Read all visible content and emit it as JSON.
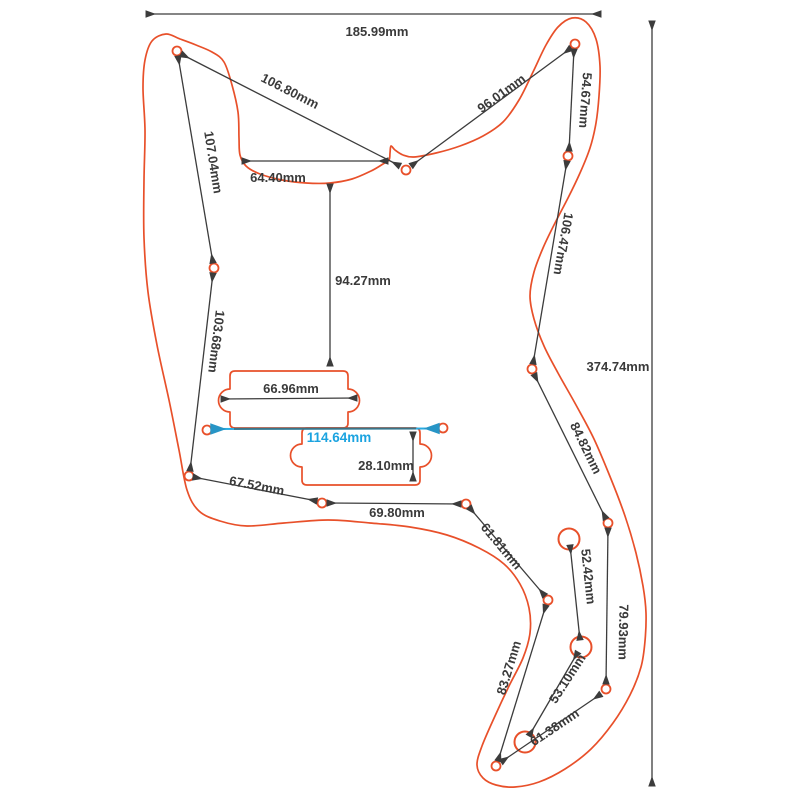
{
  "diagram": {
    "title": "Bass pickguard dimension drawing",
    "units": "mm",
    "colors": {
      "outline": "#e8502a",
      "dimension_line": "#3c3c3c",
      "highlight": "#1ba3e0",
      "background": "#ffffff"
    },
    "labels": {
      "d185_99": "185.99mm",
      "d106_80": "106.80mm",
      "d96_01": "96.01mm",
      "d54_67": "54.67mm",
      "d107_04": "107.04mm",
      "d64_40": "64.40mm",
      "d94_27": "94.27mm",
      "d103_68": "103.68mm",
      "d106_47": "106.47mm",
      "d374_74": "374.74mm",
      "d84_82": "84.82mm",
      "d66_96": "66.96mm",
      "d114_64": "114.64mm",
      "d28_10": "28.10mm",
      "d67_52": "67.52mm",
      "d69_80": "69.80mm",
      "d61_81": "61.81mm",
      "d52_42": "52.42mm",
      "d79_93": "79.93mm",
      "d83_27": "83.27mm",
      "d53_10": "53.10mm",
      "d61_38": "61.38mm"
    },
    "measurements_mm": [
      185.99,
      106.8,
      96.01,
      54.67,
      107.04,
      64.4,
      94.27,
      103.68,
      106.47,
      374.74,
      84.82,
      66.96,
      114.64,
      28.1,
      67.52,
      69.8,
      61.81,
      52.42,
      79.93,
      83.27,
      53.1,
      61.38
    ]
  }
}
